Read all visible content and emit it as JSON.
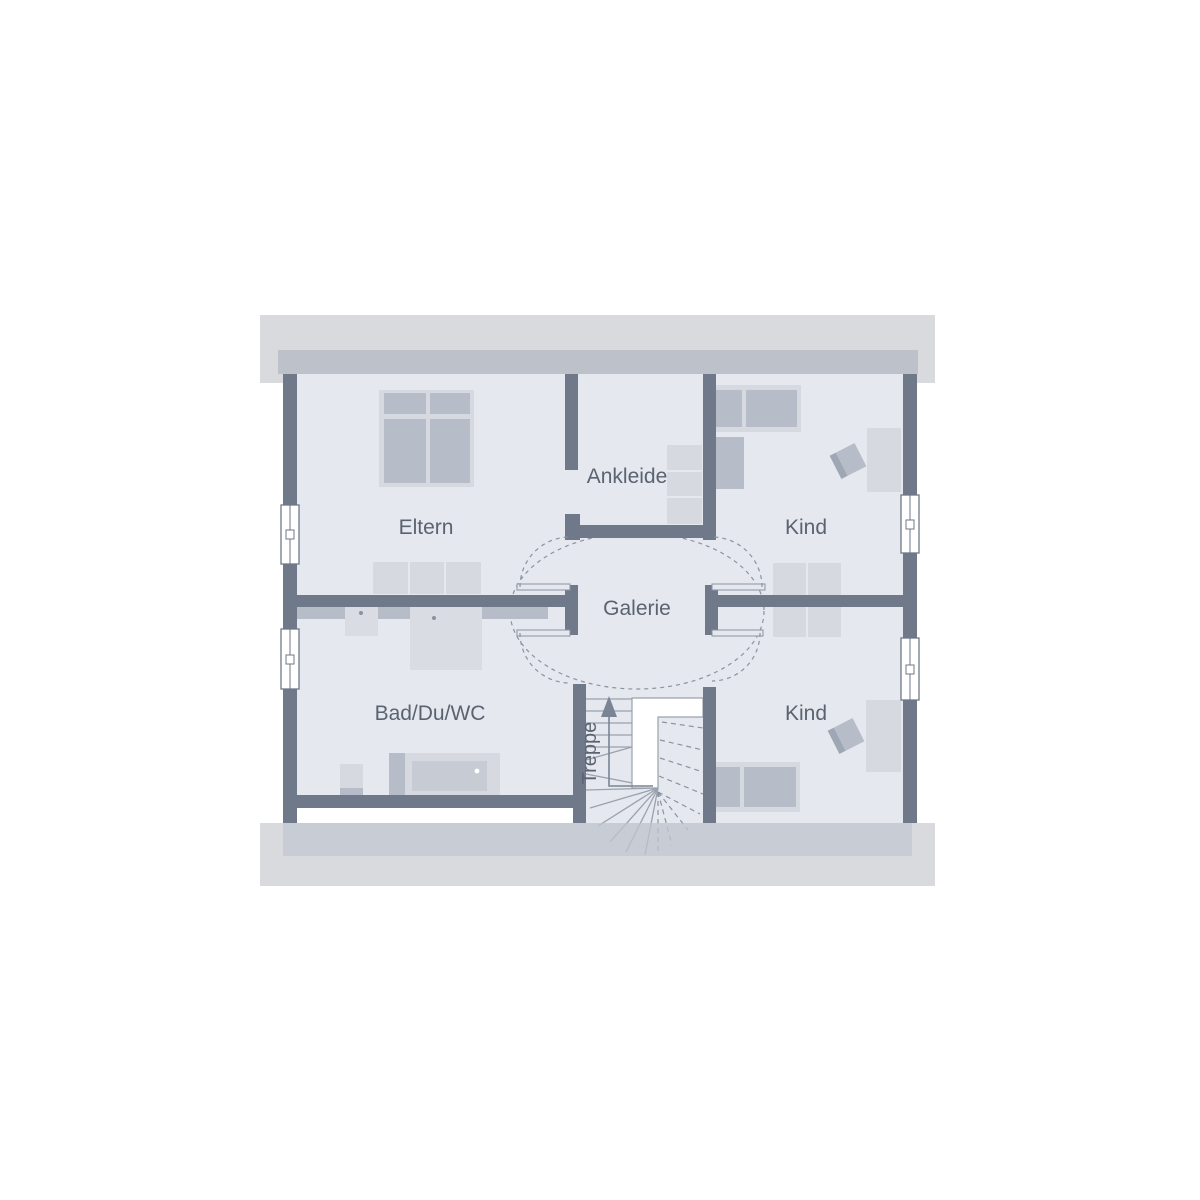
{
  "title": "Floor plan upper level",
  "rooms": {
    "eltern": "Eltern",
    "ankleide": "Ankleide",
    "kind_top": "Kind",
    "galerie": "Galerie",
    "bad": "Bad/Du/WC",
    "kind_bottom": "Kind",
    "treppe": "Treppe"
  },
  "colors": {
    "wall": "#6F7989",
    "floor": "#E5E8EE",
    "roof_band_outer": "#D9DADE",
    "roof_band_inner": "#BCC1CA",
    "furniture_light": "#D6D9E0",
    "furniture_medium": "#B7BDC8",
    "fixture_light": "#D9DCE3",
    "tub_inner": "#C6CBD4",
    "chair_back": "#9FA7B5",
    "line": "#8A93A2",
    "stair_line": "#9AA2AF",
    "arrow": "#7A8494",
    "label_text": "#5B6370",
    "white": "#FFFFFF"
  }
}
